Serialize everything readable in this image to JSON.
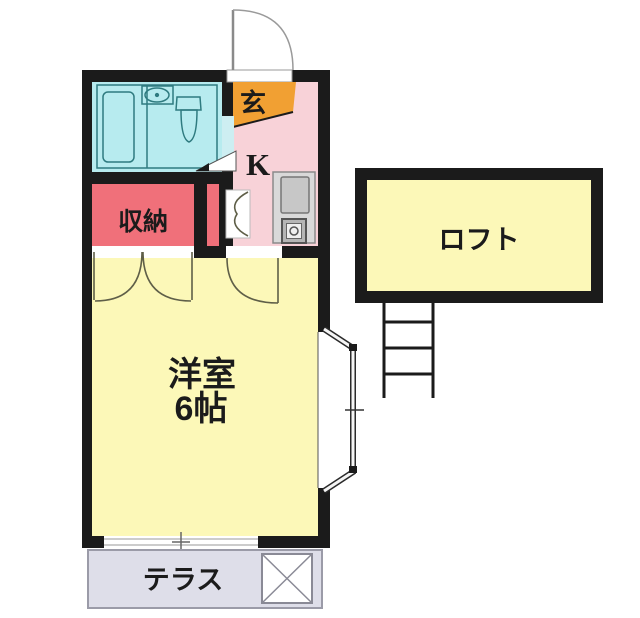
{
  "floorplan": {
    "kind": "Japanese apartment floor plan (1R with loft)",
    "labels": {
      "entrance": "玄",
      "kitchen": "K",
      "storage": "収納",
      "main_room_line1": "洋室",
      "main_room_line2": "6帖",
      "loft": "ロフト",
      "terrace": "テラス"
    },
    "colors": {
      "wall": "#1b1b1b",
      "bathroom": "#b7ebef",
      "bathroom_line": "#2f7b80",
      "entrance": "#f1a033",
      "kitchen": "#f8d2d8",
      "storage": "#f0707a",
      "room": "#fcf8b8",
      "loft": "#fcf8b8",
      "terrace": "#dedee9",
      "counter": "#d9d9d9",
      "sink": "#c7c7c7",
      "door_arc": "#5f5f48",
      "text": "#1b1b1b"
    }
  }
}
